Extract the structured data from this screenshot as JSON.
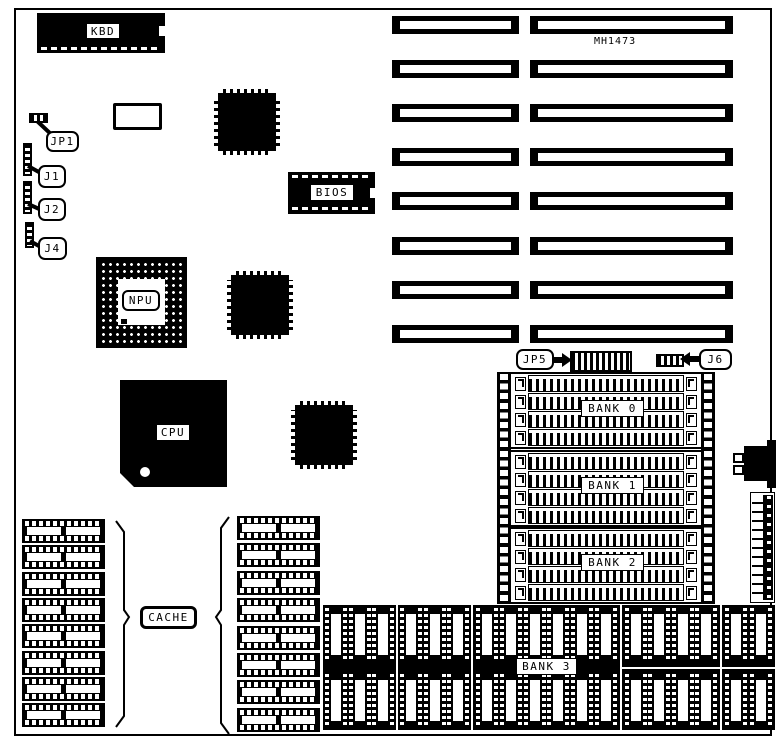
{
  "colors": {
    "ink": "#000000",
    "paper": "#ffffff"
  },
  "labels": {
    "kbd": "KBD",
    "jp1": "JP1",
    "j1": "J1",
    "j2": "J2",
    "j4": "J4",
    "bios": "BIOS",
    "npu": "NPU",
    "cpu": "CPU",
    "cache": "CACHE",
    "jp5": "JP5",
    "j6": "J6",
    "board_id": "MH1473",
    "bank0": "BANK 0",
    "bank1": "BANK 1",
    "bank2": "BANK 2",
    "bank3": "BANK 3"
  },
  "structure": {
    "expansion_slot_rows": 8,
    "expansion_slot_columns": 2,
    "simm_banks": 3,
    "simm_sockets_per_bank": 4,
    "cache_chip_columns": 2,
    "cache_chips_per_column": 8,
    "bank3_chip_rows": 2,
    "bank3_panel_chip_columns": [
      3,
      3,
      6,
      4,
      2
    ]
  }
}
